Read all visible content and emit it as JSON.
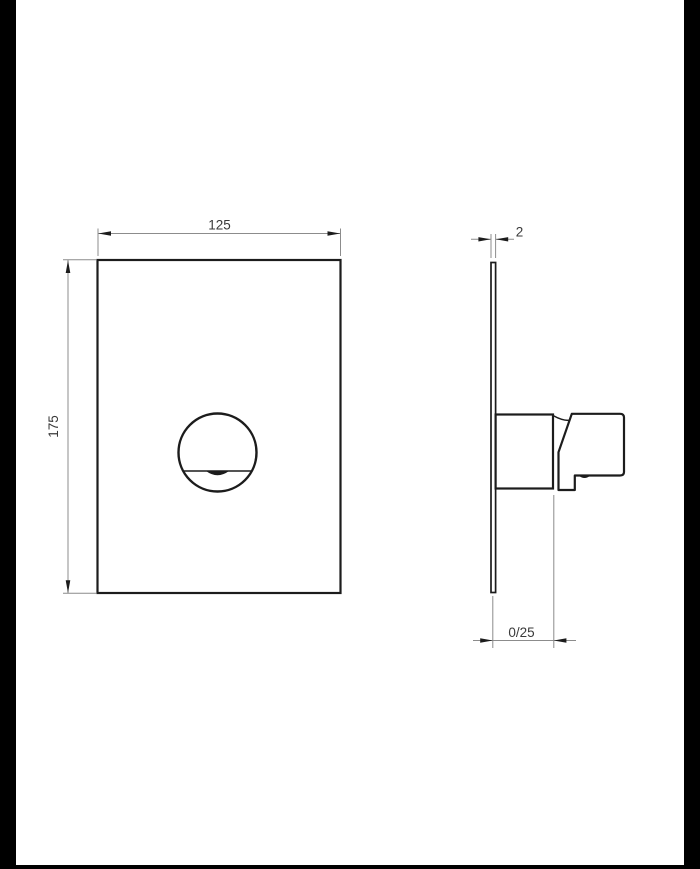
{
  "drawing": {
    "type": "technical-dimension-drawing",
    "subject": "concealed-mixer-wall-plate-front-and-side-view",
    "colors": {
      "background": "#ffffff",
      "object_line": "#1c1c1c",
      "dimension_line": "#8c8c8c",
      "arrow": "#1c1c1c",
      "text": "#3a3a3a",
      "page_border": "#000000"
    },
    "front_view": {
      "width_label": "125",
      "height_label": "175"
    },
    "side_view": {
      "thickness_label": "2",
      "depth_label": "0/25"
    }
  }
}
